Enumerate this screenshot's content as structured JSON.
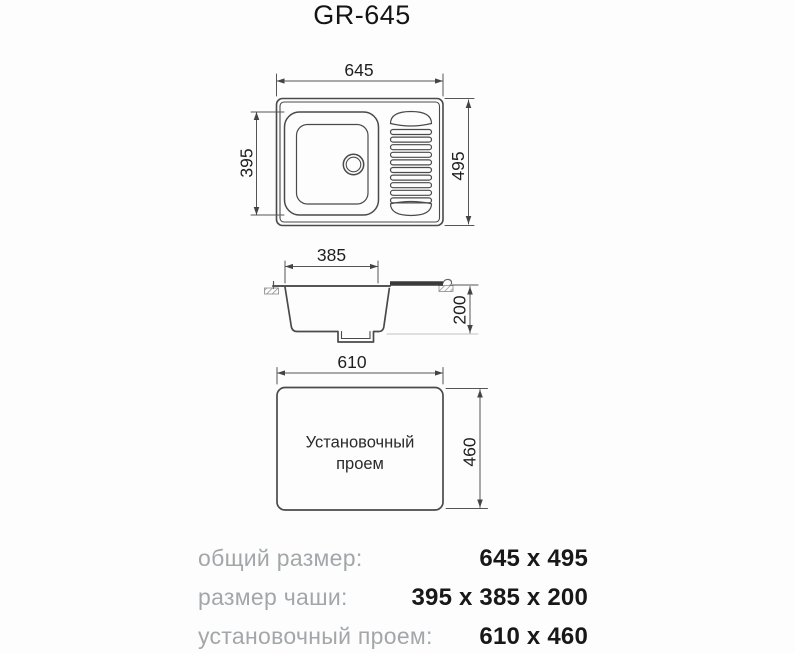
{
  "title": "GR-645",
  "drawing": {
    "top_view": {
      "width": "645",
      "height": "495",
      "bowl": "395"
    },
    "section_view": {
      "width": "385",
      "depth": "200"
    },
    "opening_view": {
      "width": "610",
      "height": "460",
      "caption1": "Установочный",
      "caption2": "проем"
    }
  },
  "specs": {
    "rows": [
      {
        "label": "общий размер:",
        "value": "645 x 495"
      },
      {
        "label": "размер чаши:",
        "value": "395 x 385 x 200"
      },
      {
        "label": "установочный проем:",
        "value": "610 x 460"
      }
    ]
  },
  "colors": {
    "line": "#4a4a4a",
    "dimension": "#555555",
    "drainboard_bar": "#3a3a3a",
    "label_gray": "#a3a7a9",
    "text": "#1f1f1f",
    "background": "#fdfdfd"
  }
}
